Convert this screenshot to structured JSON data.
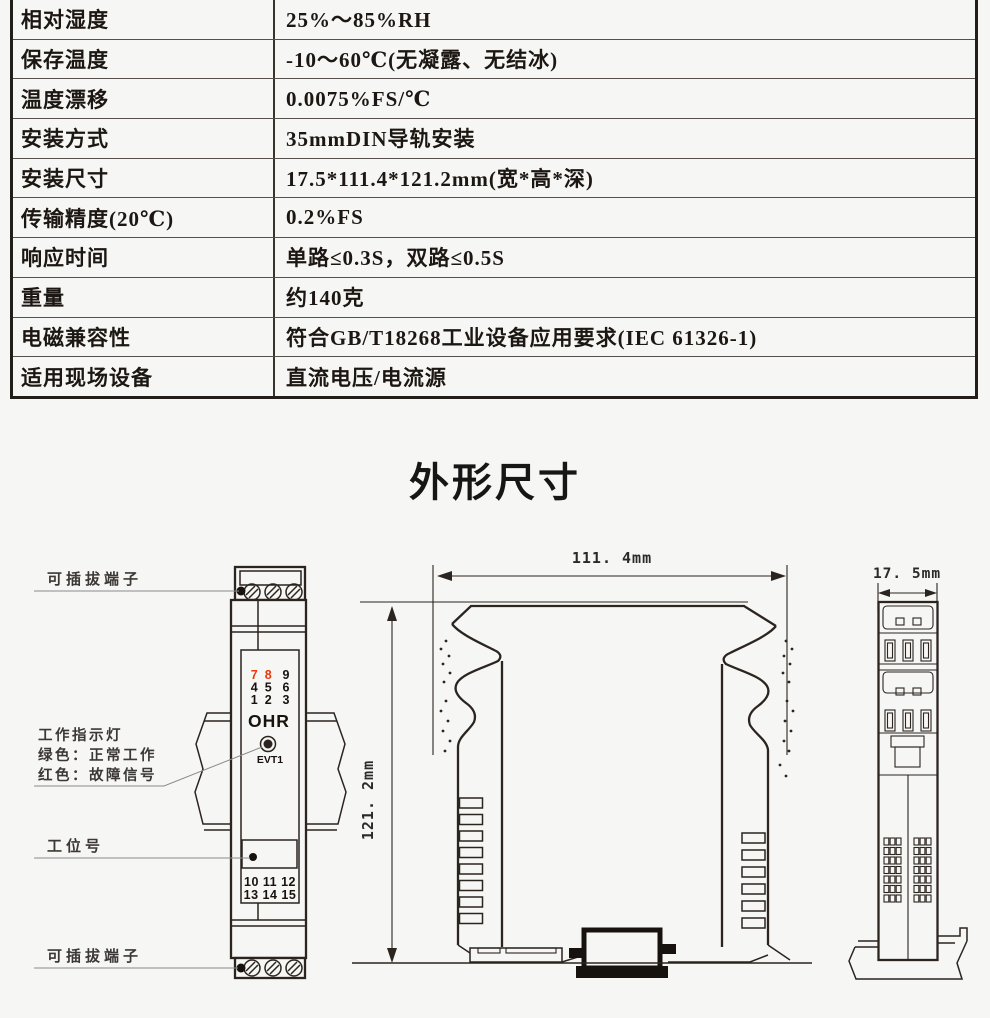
{
  "section_title": "外形尺寸",
  "spec_table": {
    "rows": [
      {
        "label": "相对湿度",
        "value": "25%～85%RH"
      },
      {
        "label": "保存温度",
        "value": "-10～60℃(无凝露、无结冰)"
      },
      {
        "label": "温度漂移",
        "value": "0.0075%FS/℃"
      },
      {
        "label": "安装方式",
        "value": "35mmDIN导轨安装"
      },
      {
        "label": "安装尺寸",
        "value": "17.5*111.4*121.2mm(宽*高*深)"
      },
      {
        "label": "传输精度(20℃)",
        "value": "0.2%FS"
      },
      {
        "label": "响应时间",
        "value": "单路≤0.3S，双路≤0.5S"
      },
      {
        "label": "重量",
        "value": "约140克"
      },
      {
        "label": "电磁兼容性",
        "value": "符合GB/T18268工业设备应用要求(IEC 61326-1)"
      },
      {
        "label": "适用现场设备",
        "value": "直流电压/电流源"
      }
    ]
  },
  "diagram": {
    "labels": {
      "pluggable_terminal_top": "可插拔端子",
      "work_indicator_line1": "工作指示灯",
      "work_indicator_line2": "绿色：正常工作",
      "work_indicator_line3": "红色：故障信号",
      "station_number": "工位号",
      "pluggable_terminal_bottom": "可插拔端子"
    },
    "dimensions": {
      "width": "111. 4mm",
      "height": "121. 2mm",
      "depth": "17. 5mm"
    },
    "module": {
      "brand": "OHR",
      "led_label": "EVT1",
      "term_top": [
        [
          "7",
          "8",
          "9"
        ],
        [
          "4",
          "5",
          "6"
        ],
        [
          "1",
          "2",
          "3"
        ]
      ],
      "red_numbers": [
        "7",
        "8"
      ],
      "term_bottom": [
        "10 11 12",
        "13 14 15"
      ]
    },
    "colors": {
      "red": "#e8380c",
      "line": "#2b241f"
    }
  }
}
